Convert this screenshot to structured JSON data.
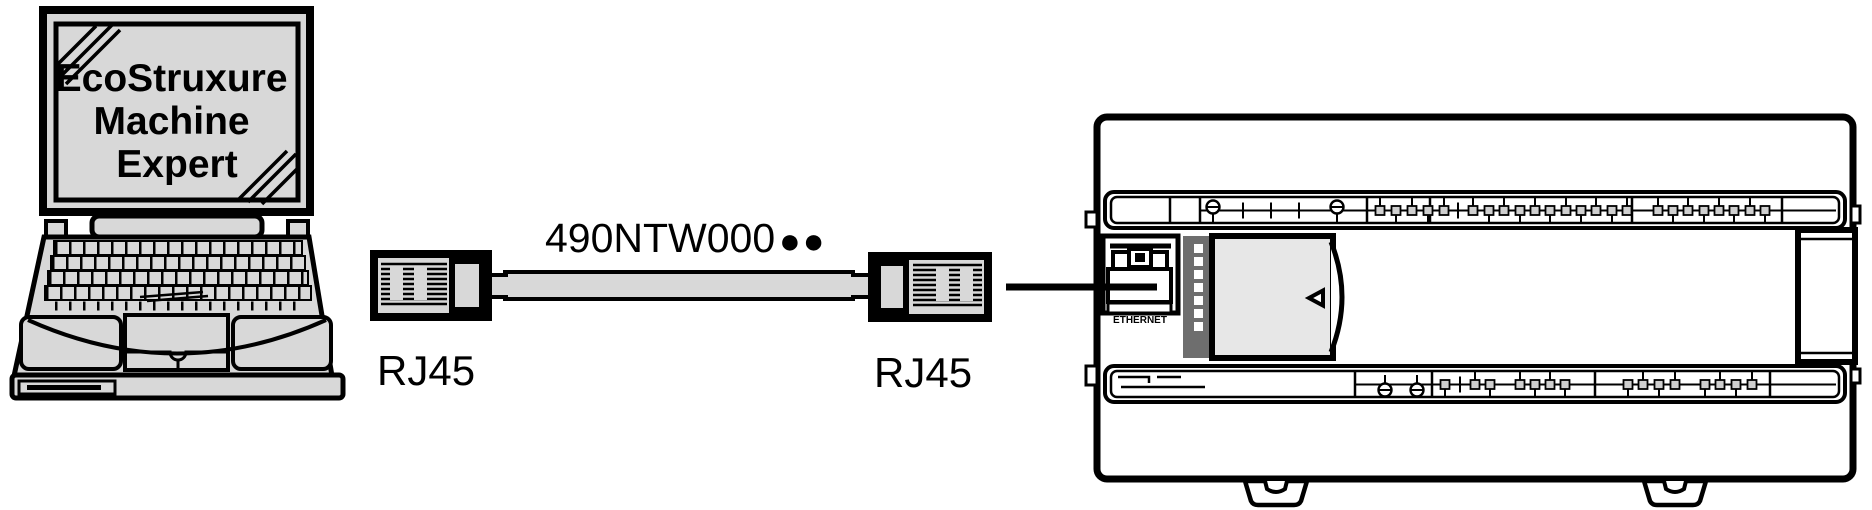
{
  "figure": {
    "description": "Laptop with EcoStruxure Machine Expert connected by Ethernet cable to logic controller ETHERNET port"
  },
  "laptop": {
    "screen_lines": [
      "EcoStruxure",
      "Machine",
      "Expert"
    ]
  },
  "cable": {
    "label": "490NTW000",
    "bullets": "●●"
  },
  "connectors": {
    "left_label": "RJ45",
    "right_label": "RJ45"
  },
  "controller": {
    "port_label": "ETHERNET"
  },
  "colors": {
    "device_fill": "#d8d8d8",
    "door_fill": "#e7e7e7",
    "led_strip_fill": "#6e6e6e",
    "line_color": "#000000",
    "background": "#ffffff"
  }
}
